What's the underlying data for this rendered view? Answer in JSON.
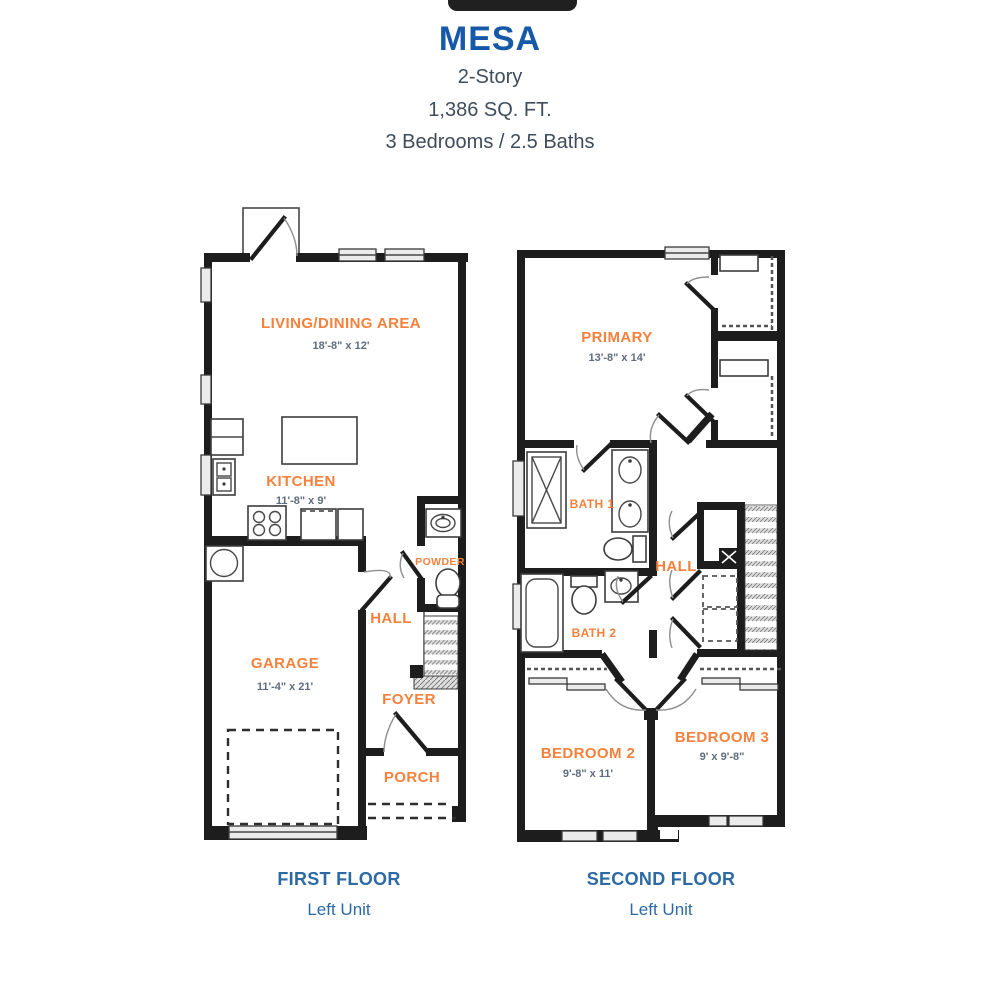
{
  "header": {
    "plan_name": "MESA",
    "story": "2-Story",
    "area": "1,386 SQ. FT.",
    "beds_baths": "3 Bedrooms / 2.5 Baths"
  },
  "colors": {
    "title_blue": "#1659a8",
    "caption_blue": "#2d6aa4",
    "subtitle_gray": "#3f4c5a",
    "room_orange": "#f5813c",
    "dim_slate": "#5e6c7b",
    "wall_black": "#1d1d1d"
  },
  "first_floor": {
    "caption": "FIRST FLOOR",
    "unit": "Left Unit",
    "rooms": {
      "living": {
        "name": "LIVING/DINING AREA",
        "dims": "18'-8\" x 12'"
      },
      "kitchen": {
        "name": "KITCHEN",
        "dims": "11'-8\" x 9'"
      },
      "garage": {
        "name": "GARAGE",
        "dims": "11'-4\" x 21'"
      },
      "powder": {
        "name": "POWDER"
      },
      "hall": {
        "name": "HALL"
      },
      "foyer": {
        "name": "FOYER"
      },
      "porch": {
        "name": "PORCH"
      }
    }
  },
  "second_floor": {
    "caption": "SECOND FLOOR",
    "unit": "Left Unit",
    "rooms": {
      "primary": {
        "name": "PRIMARY",
        "dims": "13'-8\" x 14'"
      },
      "bath1": {
        "name": "BATH 1"
      },
      "bath2": {
        "name": "BATH 2"
      },
      "hall": {
        "name": "HALL"
      },
      "bedroom2": {
        "name": "BEDROOM 2",
        "dims": "9'-8\" x 11'"
      },
      "bedroom3": {
        "name": "BEDROOM 3",
        "dims": "9' x 9'-8\""
      }
    }
  }
}
